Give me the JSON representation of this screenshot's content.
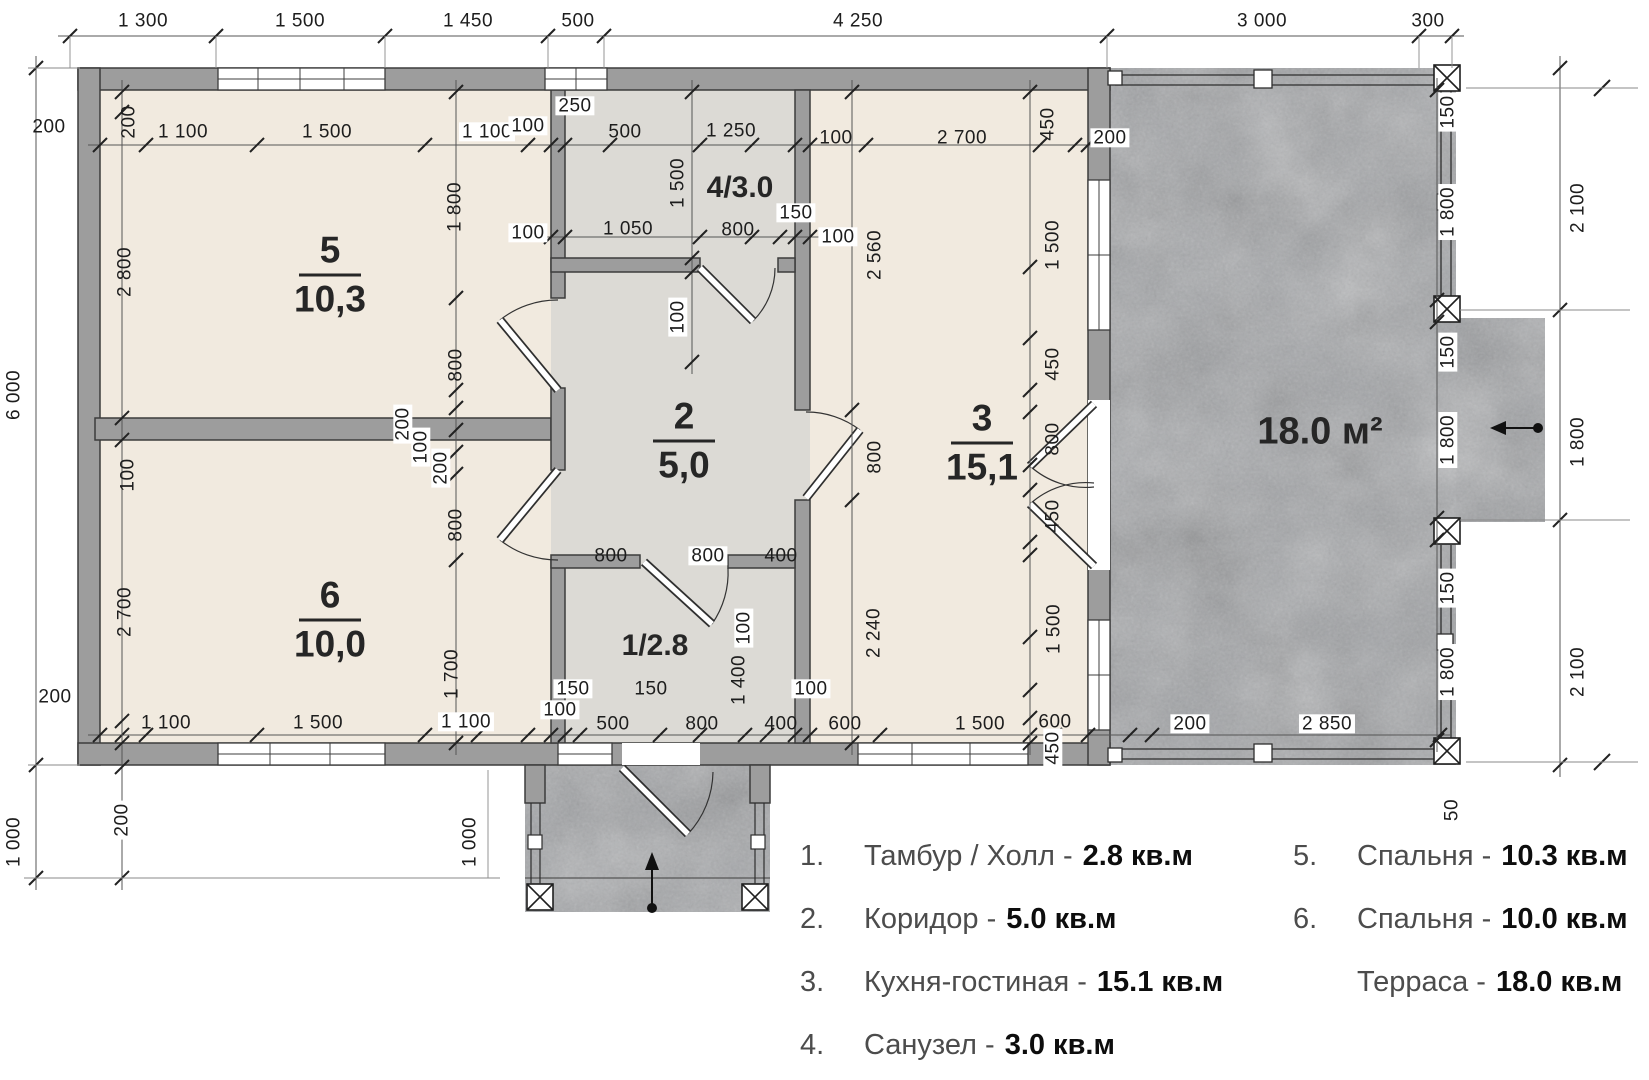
{
  "legend": {
    "left": [
      {
        "num": "1.",
        "label": "Тамбур / Холл -",
        "value": "2.8 кв.м"
      },
      {
        "num": "2.",
        "label": "Коридор -",
        "value": "5.0 кв.м"
      },
      {
        "num": "3.",
        "label": "Кухня-гостиная -",
        "value": "15.1 кв.м"
      },
      {
        "num": "4.",
        "label": "Санузел -",
        "value": "3.0 кв.м"
      }
    ],
    "right": [
      {
        "num": "5.",
        "label": "Спальня -",
        "value": "10.3 кв.м"
      },
      {
        "num": "6.",
        "label": "Спальня -",
        "value": "10.0 кв.м"
      },
      {
        "num": "",
        "label": "Терраса -",
        "value": "18.0 кв.м"
      }
    ]
  },
  "room_labels": [
    {
      "kind": "frac",
      "num": "5",
      "area": "10,3",
      "x": 330,
      "y": 275
    },
    {
      "kind": "frac",
      "num": "6",
      "area": "10,0",
      "x": 330,
      "y": 620
    },
    {
      "kind": "frac",
      "num": "2",
      "area": "5,0",
      "x": 684,
      "y": 441
    },
    {
      "kind": "frac",
      "num": "3",
      "area": "15,1",
      "x": 982,
      "y": 443
    },
    {
      "kind": "plain",
      "t": "4/3.0",
      "x": 740,
      "y": 188
    },
    {
      "kind": "plain",
      "t": "1/2.8",
      "x": 655,
      "y": 646
    },
    {
      "kind": "plain",
      "t": "18.0 м²",
      "x": 1320,
      "y": 432,
      "big": true
    }
  ],
  "dim_labels": [
    {
      "t": "1 300",
      "x": 143,
      "y": 21
    },
    {
      "t": "1 500",
      "x": 300,
      "y": 21
    },
    {
      "t": "1 450",
      "x": 468,
      "y": 21
    },
    {
      "t": "500",
      "x": 578,
      "y": 21
    },
    {
      "t": "4 250",
      "x": 858,
      "y": 21
    },
    {
      "t": "3 000",
      "x": 1262,
      "y": 21
    },
    {
      "t": "300",
      "x": 1428,
      "y": 21
    },
    {
      "t": "200",
      "x": 49,
      "y": 127
    },
    {
      "t": "200",
      "x": 129,
      "y": 122,
      "r": 1
    },
    {
      "t": "1 100",
      "x": 183,
      "y": 132
    },
    {
      "t": "1 500",
      "x": 327,
      "y": 132
    },
    {
      "t": "1 100",
      "x": 487,
      "y": 132,
      "wb": 1
    },
    {
      "t": "100",
      "x": 528,
      "y": 126,
      "wb": 1
    },
    {
      "t": "250",
      "x": 575,
      "y": 106,
      "wb": 1
    },
    {
      "t": "500",
      "x": 625,
      "y": 132
    },
    {
      "t": "1 250",
      "x": 731,
      "y": 131
    },
    {
      "t": "100",
      "x": 836,
      "y": 138
    },
    {
      "t": "2 700",
      "x": 962,
      "y": 138
    },
    {
      "t": "450",
      "x": 1048,
      "y": 124,
      "r": 1
    },
    {
      "t": "200",
      "x": 1110,
      "y": 138,
      "wb": 1
    },
    {
      "t": "100",
      "x": 528,
      "y": 233,
      "wb": 1
    },
    {
      "t": "1 050",
      "x": 628,
      "y": 229
    },
    {
      "t": "800",
      "x": 738,
      "y": 230
    },
    {
      "t": "150",
      "x": 796,
      "y": 213,
      "wb": 1
    },
    {
      "t": "100",
      "x": 838,
      "y": 237,
      "wb": 1
    },
    {
      "t": "1 500",
      "x": 678,
      "y": 183,
      "r": 1
    },
    {
      "t": "100",
      "x": 678,
      "y": 317,
      "r": 1,
      "wb": 1
    },
    {
      "t": "2 800",
      "x": 125,
      "y": 272,
      "r": 1
    },
    {
      "t": "100",
      "x": 128,
      "y": 475,
      "r": 1
    },
    {
      "t": "2 700",
      "x": 125,
      "y": 612,
      "r": 1
    },
    {
      "t": "1 800",
      "x": 455,
      "y": 207,
      "r": 1
    },
    {
      "t": "800",
      "x": 456,
      "y": 365,
      "r": 1
    },
    {
      "t": "200",
      "x": 403,
      "y": 424,
      "r": 1,
      "wb": 1
    },
    {
      "t": "100",
      "x": 421,
      "y": 447,
      "r": 1,
      "wb": 1
    },
    {
      "t": "200",
      "x": 441,
      "y": 468,
      "r": 1,
      "wb": 1
    },
    {
      "t": "800",
      "x": 456,
      "y": 525,
      "r": 1
    },
    {
      "t": "1 700",
      "x": 452,
      "y": 674,
      "r": 1
    },
    {
      "t": "800",
      "x": 611,
      "y": 556
    },
    {
      "t": "800",
      "x": 708,
      "y": 556,
      "wb": 1
    },
    {
      "t": "400",
      "x": 781,
      "y": 556
    },
    {
      "t": "150",
      "x": 573,
      "y": 689,
      "wb": 1
    },
    {
      "t": "150",
      "x": 651,
      "y": 689
    },
    {
      "t": "100",
      "x": 744,
      "y": 628,
      "r": 1,
      "wb": 1
    },
    {
      "t": "1 400",
      "x": 739,
      "y": 680,
      "r": 1
    },
    {
      "t": "100",
      "x": 560,
      "y": 710,
      "wb": 1
    },
    {
      "t": "100",
      "x": 811,
      "y": 689,
      "wb": 1
    },
    {
      "t": "2 560",
      "x": 875,
      "y": 255,
      "r": 1
    },
    {
      "t": "800",
      "x": 875,
      "y": 457,
      "r": 1
    },
    {
      "t": "2 240",
      "x": 874,
      "y": 633,
      "r": 1
    },
    {
      "t": "1 500",
      "x": 1053,
      "y": 245,
      "r": 1
    },
    {
      "t": "450",
      "x": 1053,
      "y": 364,
      "r": 1
    },
    {
      "t": "800",
      "x": 1053,
      "y": 439,
      "r": 1
    },
    {
      "t": "450",
      "x": 1053,
      "y": 516,
      "r": 1
    },
    {
      "t": "1 500",
      "x": 1054,
      "y": 629,
      "r": 1
    },
    {
      "t": "450",
      "x": 1053,
      "y": 748,
      "r": 1,
      "wb": 1
    },
    {
      "t": "200",
      "x": 55,
      "y": 697
    },
    {
      "t": "1 100",
      "x": 166,
      "y": 723
    },
    {
      "t": "1 500",
      "x": 318,
      "y": 723
    },
    {
      "t": "1 100",
      "x": 466,
      "y": 722,
      "wb": 1
    },
    {
      "t": "500",
      "x": 613,
      "y": 724
    },
    {
      "t": "800",
      "x": 702,
      "y": 724
    },
    {
      "t": "400",
      "x": 781,
      "y": 724
    },
    {
      "t": "600",
      "x": 845,
      "y": 724
    },
    {
      "t": "1 500",
      "x": 980,
      "y": 724
    },
    {
      "t": "600",
      "x": 1055,
      "y": 722
    },
    {
      "t": "200",
      "x": 1190,
      "y": 724,
      "wb": 1
    },
    {
      "t": "2 850",
      "x": 1327,
      "y": 724,
      "wb": 1
    },
    {
      "t": "6 000",
      "x": 14,
      "y": 395,
      "r": 1
    },
    {
      "t": "1 000",
      "x": 14,
      "y": 842,
      "r": 1
    },
    {
      "t": "200",
      "x": 122,
      "y": 820,
      "r": 1,
      "wb": 1
    },
    {
      "t": "1 000",
      "x": 470,
      "y": 842,
      "r": 1
    },
    {
      "t": "150",
      "x": 1448,
      "y": 112,
      "r": 1,
      "wb": 1
    },
    {
      "t": "1 800",
      "x": 1448,
      "y": 212,
      "r": 1,
      "wb": 1
    },
    {
      "t": "150",
      "x": 1448,
      "y": 352,
      "r": 1,
      "wb": 1
    },
    {
      "t": "1 800",
      "x": 1448,
      "y": 440,
      "r": 1,
      "wb": 1
    },
    {
      "t": "150",
      "x": 1448,
      "y": 588,
      "r": 1,
      "wb": 1
    },
    {
      "t": "1 800",
      "x": 1448,
      "y": 672,
      "r": 1,
      "wb": 1
    },
    {
      "t": "2 100",
      "x": 1578,
      "y": 208,
      "r": 1
    },
    {
      "t": "1 800",
      "x": 1578,
      "y": 442,
      "r": 1
    },
    {
      "t": "2 100",
      "x": 1578,
      "y": 672,
      "r": 1
    },
    {
      "t": "50",
      "x": 1452,
      "y": 810,
      "r": 1,
      "wb": 1
    }
  ]
}
